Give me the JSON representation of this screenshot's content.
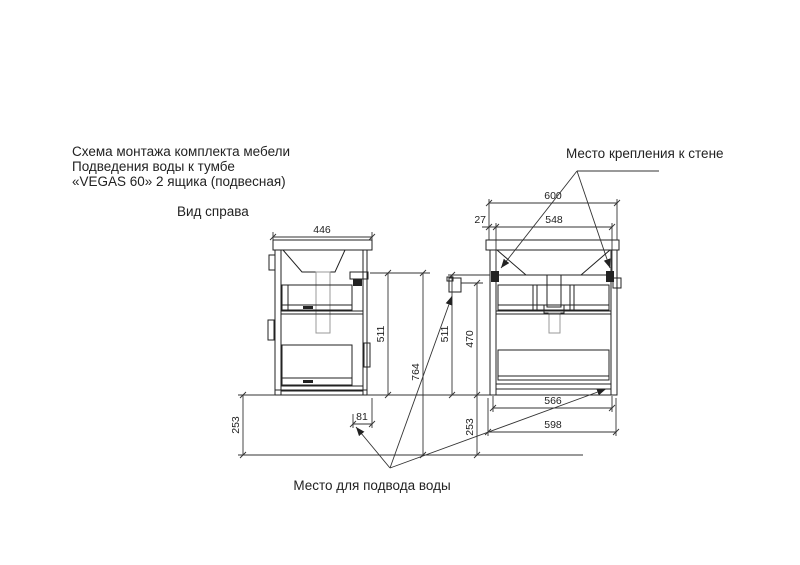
{
  "title": {
    "line1": "Схема монтажа комплекта мебели",
    "line2": "Подведения воды к тумбе",
    "line3": "«VEGAS 60» 2 ящика (подвесная)"
  },
  "labels": {
    "view_name": "Вид справа",
    "wall_mount": "Место крепления к стене",
    "water_supply": "Место для подвода воды"
  },
  "dims": {
    "side_depth": "446",
    "side_height": "511",
    "side_total_height": "764",
    "side_floor_gap": "253",
    "water_wall_offset": "81",
    "front_width": "600",
    "mount_span": "548",
    "mount_inset": "27",
    "front_height": "511",
    "water_height": "470",
    "front_floor_gap": "253",
    "inner_width": "566",
    "body_width": "598"
  },
  "colors": {
    "line": "#222222",
    "light_line": "#999999",
    "background": "#ffffff"
  }
}
